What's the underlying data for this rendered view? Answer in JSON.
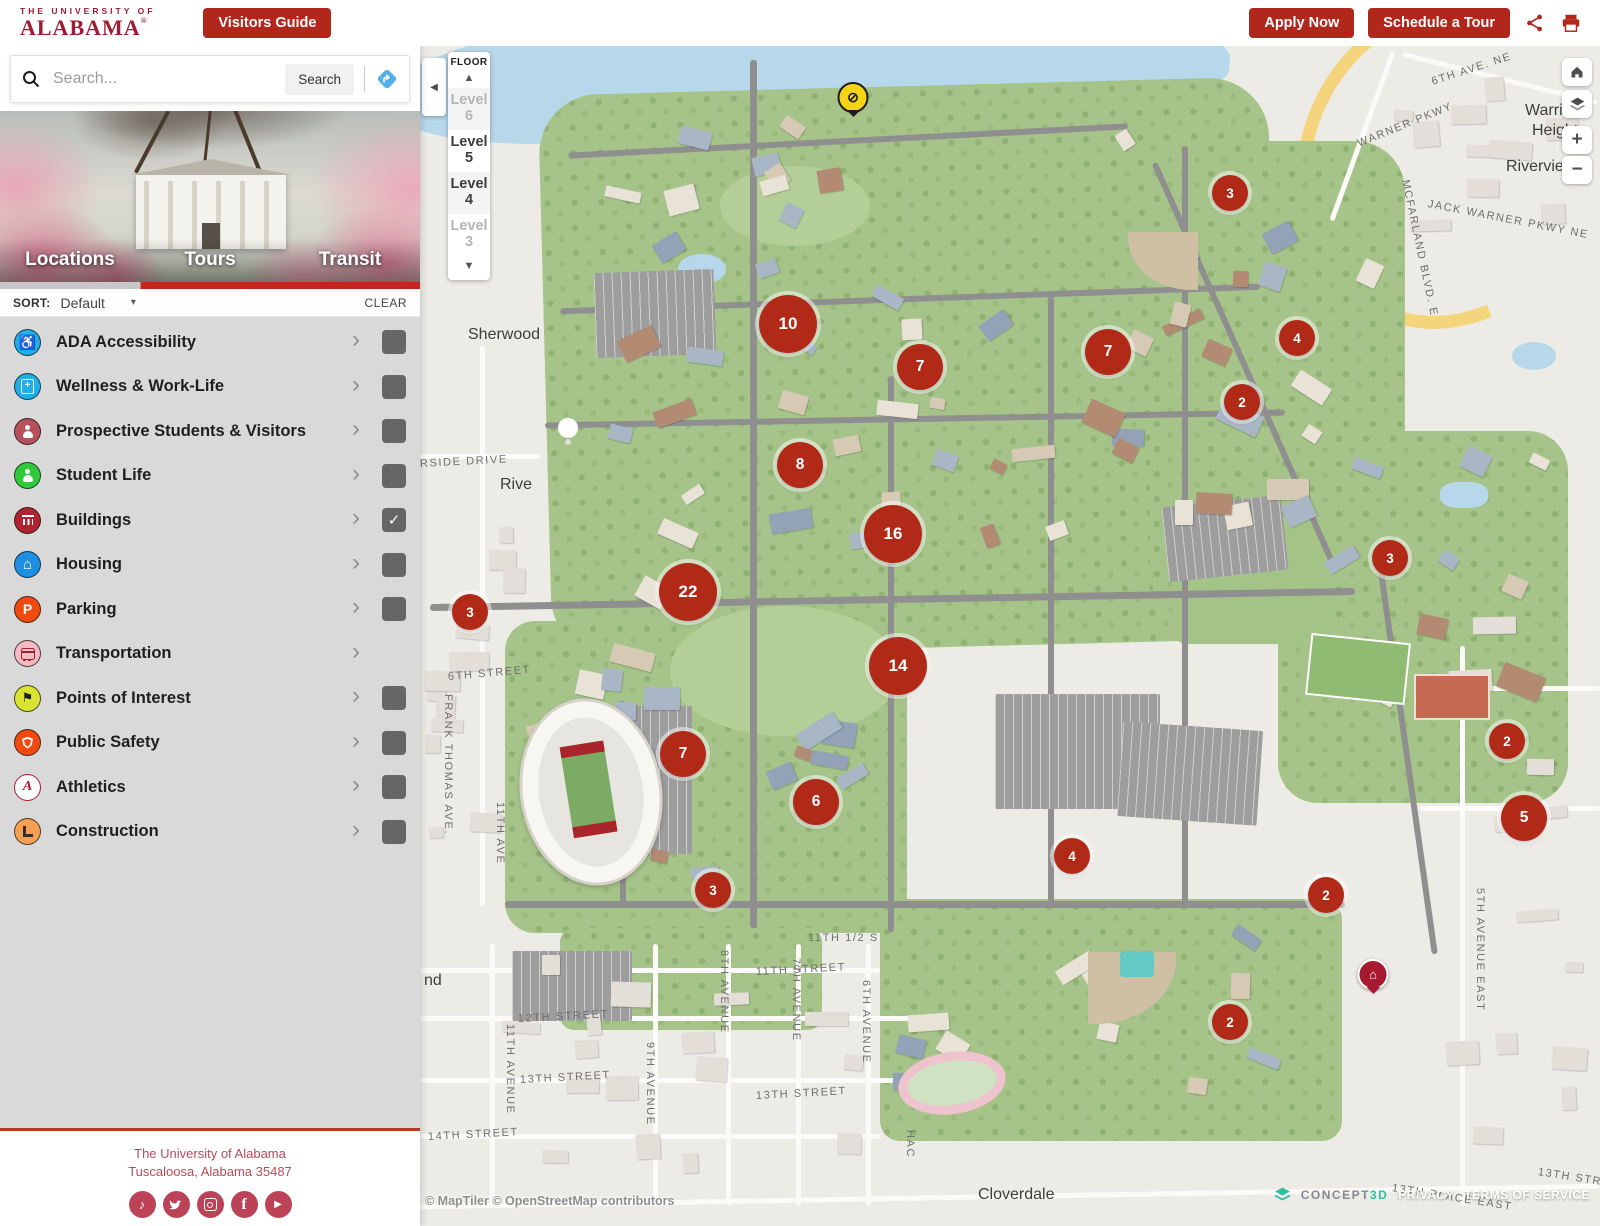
{
  "colors": {
    "crimson": "#9e1b32",
    "button_red": "#b1271c",
    "marker_red": "#b12a18",
    "tab_red": "#c3261c",
    "concept3d_teal": "#2bbfa3"
  },
  "header": {
    "logo_top": "THE UNIVERSITY OF",
    "logo_main": "ALABAMA",
    "logo_reg": "®",
    "visitors_guide": "Visitors Guide",
    "apply_now": "Apply Now",
    "schedule_tour": "Schedule a Tour"
  },
  "search": {
    "placeholder": "Search...",
    "button": "Search"
  },
  "tabs": [
    {
      "label": "Locations",
      "active": true
    },
    {
      "label": "Tours",
      "active": false
    },
    {
      "label": "Transit",
      "active": false
    }
  ],
  "sort": {
    "label": "SORT:",
    "value": "Default",
    "caret": "▾",
    "clear": "CLEAR"
  },
  "categories": [
    {
      "label": "ADA Accessibility",
      "icon": "ada-icon",
      "color": "#1fb0ea",
      "glyph": "wheelchair",
      "has_checkbox": true,
      "checked": false
    },
    {
      "label": "Wellness & Work-Life",
      "icon": "wellness-icon",
      "color": "#1fb0ea",
      "glyph": "clipboard",
      "has_checkbox": true,
      "checked": false
    },
    {
      "label": "Prospective Students & Visitors",
      "icon": "prospective-icon",
      "color": "#b8505c",
      "glyph": "person",
      "has_checkbox": true,
      "checked": false
    },
    {
      "label": "Student Life",
      "icon": "student-life-icon",
      "color": "#2fca3c",
      "glyph": "person",
      "has_checkbox": true,
      "checked": false
    },
    {
      "label": "Buildings",
      "icon": "buildings-icon",
      "color": "#b02430",
      "glyph": "building",
      "has_checkbox": true,
      "checked": true
    },
    {
      "label": "Housing",
      "icon": "housing-icon",
      "color": "#1e8fe2",
      "glyph": "house",
      "has_checkbox": true,
      "checked": false
    },
    {
      "label": "Parking",
      "icon": "parking-icon",
      "color": "#f14a0e",
      "glyph": "P",
      "has_checkbox": true,
      "checked": false
    },
    {
      "label": "Transportation",
      "icon": "transportation-icon",
      "color": "#f6b9c1",
      "glyph": "bus",
      "has_checkbox": false,
      "checked": false
    },
    {
      "label": "Points of Interest",
      "icon": "points-of-interest-icon",
      "color": "#d9e430",
      "glyph": "flag",
      "has_checkbox": true,
      "checked": false
    },
    {
      "label": "Public Safety",
      "icon": "public-safety-icon",
      "color": "#f1490f",
      "glyph": "shield",
      "has_checkbox": true,
      "checked": false
    },
    {
      "label": "Athletics",
      "icon": "athletics-icon",
      "color": "#ffffff",
      "glyph": "script-A",
      "has_checkbox": true,
      "checked": false
    },
    {
      "label": "Construction",
      "icon": "construction-icon",
      "color": "#f6a054",
      "glyph": "barricade",
      "has_checkbox": true,
      "checked": false
    }
  ],
  "footer": {
    "line1": "The University of Alabama",
    "line2": "Tuscaloosa, Alabama 35487",
    "social": [
      "tiktok-icon",
      "twitter-icon",
      "instagram-icon",
      "facebook-icon",
      "youtube-icon"
    ]
  },
  "map": {
    "floor_control": {
      "title": "FLOOR",
      "up": "▲",
      "down": "▼",
      "levels": [
        {
          "label": "Level 6",
          "dim": true
        },
        {
          "label": "Level 5",
          "dim": false
        },
        {
          "label": "Level 4",
          "dim": false
        },
        {
          "label": "Level 3",
          "dim": true
        }
      ]
    },
    "controls": [
      "home-icon",
      "layers-icon",
      "zoom-in",
      "zoom-out"
    ],
    "zoom_in": "+",
    "zoom_out": "−",
    "collapse": "◀",
    "clusters": [
      {
        "count": "10",
        "x": 368,
        "y": 278,
        "size": "lg"
      },
      {
        "count": "7",
        "x": 500,
        "y": 321,
        "size": "md"
      },
      {
        "count": "3",
        "x": 810,
        "y": 147,
        "size": "sm"
      },
      {
        "count": "7",
        "x": 688,
        "y": 306,
        "size": "md"
      },
      {
        "count": "4",
        "x": 877,
        "y": 292,
        "size": "sm"
      },
      {
        "count": "2",
        "x": 822,
        "y": 356,
        "size": "sm"
      },
      {
        "count": "8",
        "x": 380,
        "y": 419,
        "size": "md"
      },
      {
        "count": "16",
        "x": 473,
        "y": 488,
        "size": "lg"
      },
      {
        "count": "3",
        "x": 970,
        "y": 512,
        "size": "sm"
      },
      {
        "count": "22",
        "x": 268,
        "y": 546,
        "size": "lg"
      },
      {
        "count": "3",
        "x": 50,
        "y": 566,
        "size": "sm"
      },
      {
        "count": "14",
        "x": 478,
        "y": 620,
        "size": "lg"
      },
      {
        "count": "7",
        "x": 263,
        "y": 708,
        "size": "md"
      },
      {
        "count": "2",
        "x": 1087,
        "y": 695,
        "size": "sm"
      },
      {
        "count": "6",
        "x": 396,
        "y": 756,
        "size": "md"
      },
      {
        "count": "5",
        "x": 1104,
        "y": 772,
        "size": "md"
      },
      {
        "count": "4",
        "x": 652,
        "y": 810,
        "size": "sm"
      },
      {
        "count": "2",
        "x": 906,
        "y": 849,
        "size": "sm"
      },
      {
        "count": "3",
        "x": 293,
        "y": 844,
        "size": "sm"
      },
      {
        "count": "2",
        "x": 810,
        "y": 976,
        "size": "sm"
      }
    ],
    "pins": [
      {
        "type": "closure-marker",
        "style": "yellow",
        "glyph": "⊘",
        "x": 433,
        "y": 78
      },
      {
        "type": "building-marker",
        "style": "red",
        "glyph": "⌂",
        "x": 953,
        "y": 955
      }
    ],
    "labels": [
      {
        "t": "Sherwood",
        "x": 48,
        "y": 280,
        "c": "place",
        "r": 0
      },
      {
        "t": "Rive",
        "x": 80,
        "y": 430,
        "c": "place",
        "r": 0
      },
      {
        "t": "nd",
        "x": 4,
        "y": 926,
        "c": "place",
        "r": 0
      },
      {
        "t": "Cloverdale",
        "x": 558,
        "y": 1140,
        "c": "place",
        "r": 0
      },
      {
        "t": "Warrior",
        "x": 1105,
        "y": 56,
        "c": "place",
        "r": 0
      },
      {
        "t": "Heights",
        "x": 1112,
        "y": 76,
        "c": "place",
        "r": 0
      },
      {
        "t": "Riverview",
        "x": 1086,
        "y": 112,
        "c": "place",
        "r": 0
      },
      {
        "t": "RSIDE DRIVE",
        "x": 0,
        "y": 412,
        "c": "street",
        "r": -3
      },
      {
        "t": "6TH STREET",
        "x": 28,
        "y": 625,
        "c": "street",
        "r": -5
      },
      {
        "t": "11TH 1/2 S",
        "x": 388,
        "y": 886,
        "c": "street",
        "r": 0
      },
      {
        "t": "11TH STREET",
        "x": 336,
        "y": 920,
        "c": "street",
        "r": -3
      },
      {
        "t": "12TH STREET",
        "x": 98,
        "y": 967,
        "c": "street",
        "r": -3
      },
      {
        "t": "13TH STREET",
        "x": 100,
        "y": 1028,
        "c": "street",
        "r": -3
      },
      {
        "t": "13TH STREET",
        "x": 336,
        "y": 1044,
        "c": "street",
        "r": -3
      },
      {
        "t": "14TH STREET",
        "x": 8,
        "y": 1085,
        "c": "street",
        "r": -3
      },
      {
        "t": "WARNER PKWY",
        "x": 938,
        "y": 92,
        "c": "street",
        "r": -22
      },
      {
        "t": "JACK WARNER PKWY NE",
        "x": 1008,
        "y": 152,
        "c": "street",
        "r": 11
      },
      {
        "t": "MCFARLAND BLVD. E",
        "x": 985,
        "y": 128,
        "c": "street",
        "r": 78
      },
      {
        "t": "6TH AVE. NE",
        "x": 1012,
        "y": 30,
        "c": "street",
        "r": -18
      },
      {
        "t": "13TH PLACE EAST",
        "x": 972,
        "y": 1136,
        "c": "street",
        "r": 9
      },
      {
        "t": "13TH STR",
        "x": 1118,
        "y": 1120,
        "c": "street",
        "r": 9
      },
      {
        "t": "FRANK THOMAS AVE.",
        "x": 22,
        "y": 648,
        "c": "street v",
        "r": 0
      },
      {
        "t": "11TH AVE",
        "x": 74,
        "y": 756,
        "c": "street v",
        "r": 0
      },
      {
        "t": "11TH AVENUE",
        "x": 84,
        "y": 978,
        "c": "street v",
        "r": 0
      },
      {
        "t": "9TH AVENUE",
        "x": 224,
        "y": 996,
        "c": "street v",
        "r": 0
      },
      {
        "t": "8TH AVENUE",
        "x": 298,
        "y": 904,
        "c": "street v",
        "r": 0
      },
      {
        "t": "7TH AVENUE",
        "x": 370,
        "y": 912,
        "c": "street v",
        "r": 0
      },
      {
        "t": "6TH AVENUE",
        "x": 440,
        "y": 934,
        "c": "street v",
        "r": 0
      },
      {
        "t": "HAC",
        "x": 484,
        "y": 1084,
        "c": "street v",
        "r": 0
      },
      {
        "t": "5TH AVENUE EAST",
        "x": 1054,
        "y": 842,
        "c": "street v",
        "r": 0
      }
    ],
    "attribution_left": "© MapTiler © OpenStreetMap contributors",
    "attribution_right": {
      "brand_gray": "CONCEPT",
      "brand_teal": "3D",
      "privacy": "PRIVACY",
      "terms": "TERMS OF SERVICE"
    }
  }
}
